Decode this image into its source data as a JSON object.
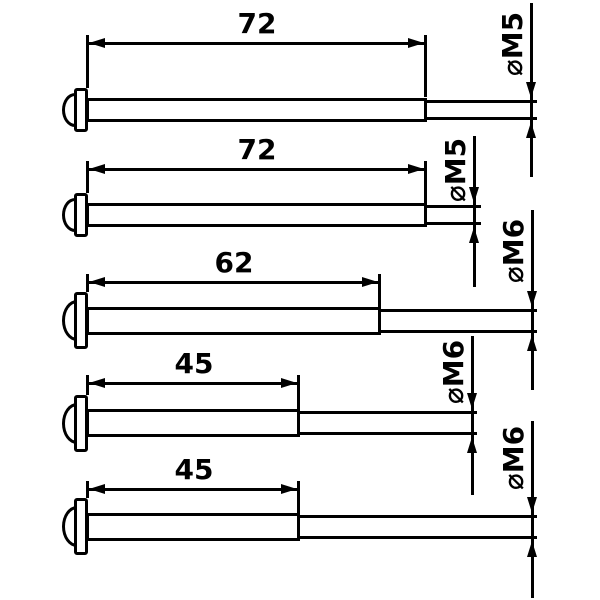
{
  "drawing": {
    "type": "technical-dimension-drawing",
    "subject": "pan-head machine screws, side view with length and thread diameter dimensions",
    "colors": {
      "line": "#000000",
      "background": "#ffffff"
    },
    "rows": [
      {
        "length_label": "72",
        "length_mm": 72,
        "thread": "M5",
        "diameter_label": "⌀M5"
      },
      {
        "length_label": "72",
        "length_mm": 72,
        "thread": "M5",
        "diameter_label": "⌀M5"
      },
      {
        "length_label": "62",
        "length_mm": 62,
        "thread": "M6",
        "diameter_label": "⌀M6"
      },
      {
        "length_label": "45",
        "length_mm": 45,
        "thread": "M6",
        "diameter_label": "⌀M6"
      },
      {
        "length_label": "45",
        "length_mm": 45,
        "thread": "M6",
        "diameter_label": "⌀M6"
      }
    ]
  }
}
